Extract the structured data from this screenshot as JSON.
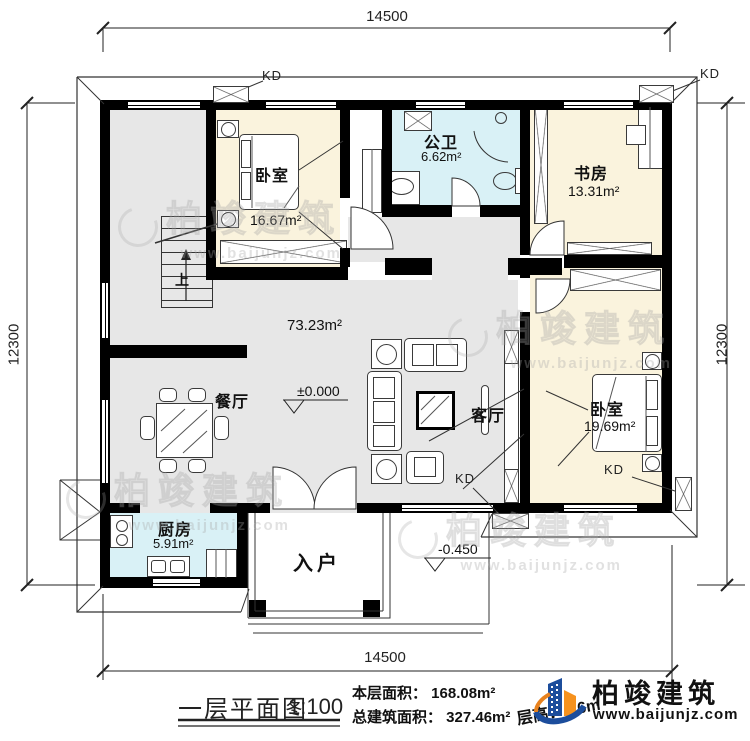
{
  "dimensions": {
    "top": "14500",
    "bottom": "14500",
    "left": "12300",
    "right": "12300"
  },
  "rooms": {
    "bedroom1": {
      "name": "卧室",
      "area": "16.67m²"
    },
    "bathroom": {
      "name": "公卫",
      "area": "6.62m²"
    },
    "study": {
      "name": "书房",
      "area": "13.31m²"
    },
    "living": {
      "area": "73.23m²",
      "living_label": "客厅",
      "dining_label": "餐厅"
    },
    "bedroom2": {
      "name": "卧室",
      "area": "19.69m²"
    },
    "kitchen": {
      "name": "厨房",
      "area": "5.91m²"
    },
    "entry": {
      "name": "入户"
    }
  },
  "levels": {
    "main": "±0.000",
    "entry": "-0.450"
  },
  "stairs": {
    "up_label": "上"
  },
  "kd_labels": [
    "KD",
    "KD",
    "KD",
    "KD"
  ],
  "title_block": {
    "title": "一层平面图",
    "scale": "1:100",
    "floor_area": "本层面积： 168.08m²",
    "total_area": "总建筑面积： 327.46m²",
    "floor_height": "层高：3.6m"
  },
  "brand": {
    "name": "柏竣建筑",
    "website": "www.baijunjz.com"
  },
  "watermark": {
    "text": "柏竣建筑",
    "website": "www.baijunjz.com"
  },
  "colors": {
    "wall": "#000000",
    "floor": "#e7e7e7",
    "bedroom": "#faf3dd",
    "wet": "#d9f1f6",
    "brand_blue": "#1c4d9c",
    "brand_orange": "#f6921e"
  }
}
